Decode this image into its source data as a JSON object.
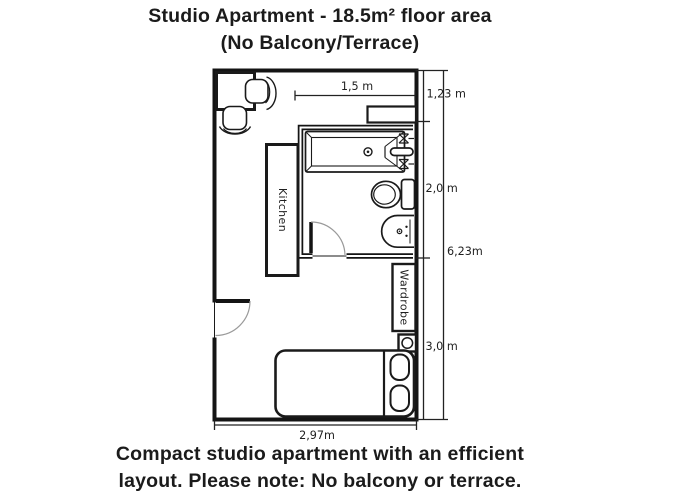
{
  "title": {
    "line1": "Studio Apartment - 18.5m² floor area",
    "line2": "(No Balcony/Terrace)"
  },
  "caption": {
    "line1": "Compact studio apartment with an efficient",
    "line2": "layout. Please note: No balcony or terrace."
  },
  "floor_plan": {
    "room_labels": {
      "kitchen": "Kitchen",
      "wardrobe": "Wardrobe"
    },
    "dimensions": {
      "top_width": "1,5 m",
      "right_upper": "1,23 m",
      "right_middle": "2,0 m",
      "right_lower": "3,0 m",
      "right_total": "6,23m",
      "bottom_width": "2,97m"
    },
    "fixtures": [
      "desk-with-two-chairs",
      "bathtub-with-faucet",
      "toilet",
      "sink",
      "shelf",
      "kitchen-counter",
      "wardrobe",
      "stool",
      "bed-with-two-pillows",
      "entrance-door",
      "bathroom-door"
    ],
    "colors": {
      "wall": "#141414",
      "fixture_line": "#1a1a1a",
      "door_arc": "#9a9a9a",
      "background": "#ffffff"
    }
  }
}
